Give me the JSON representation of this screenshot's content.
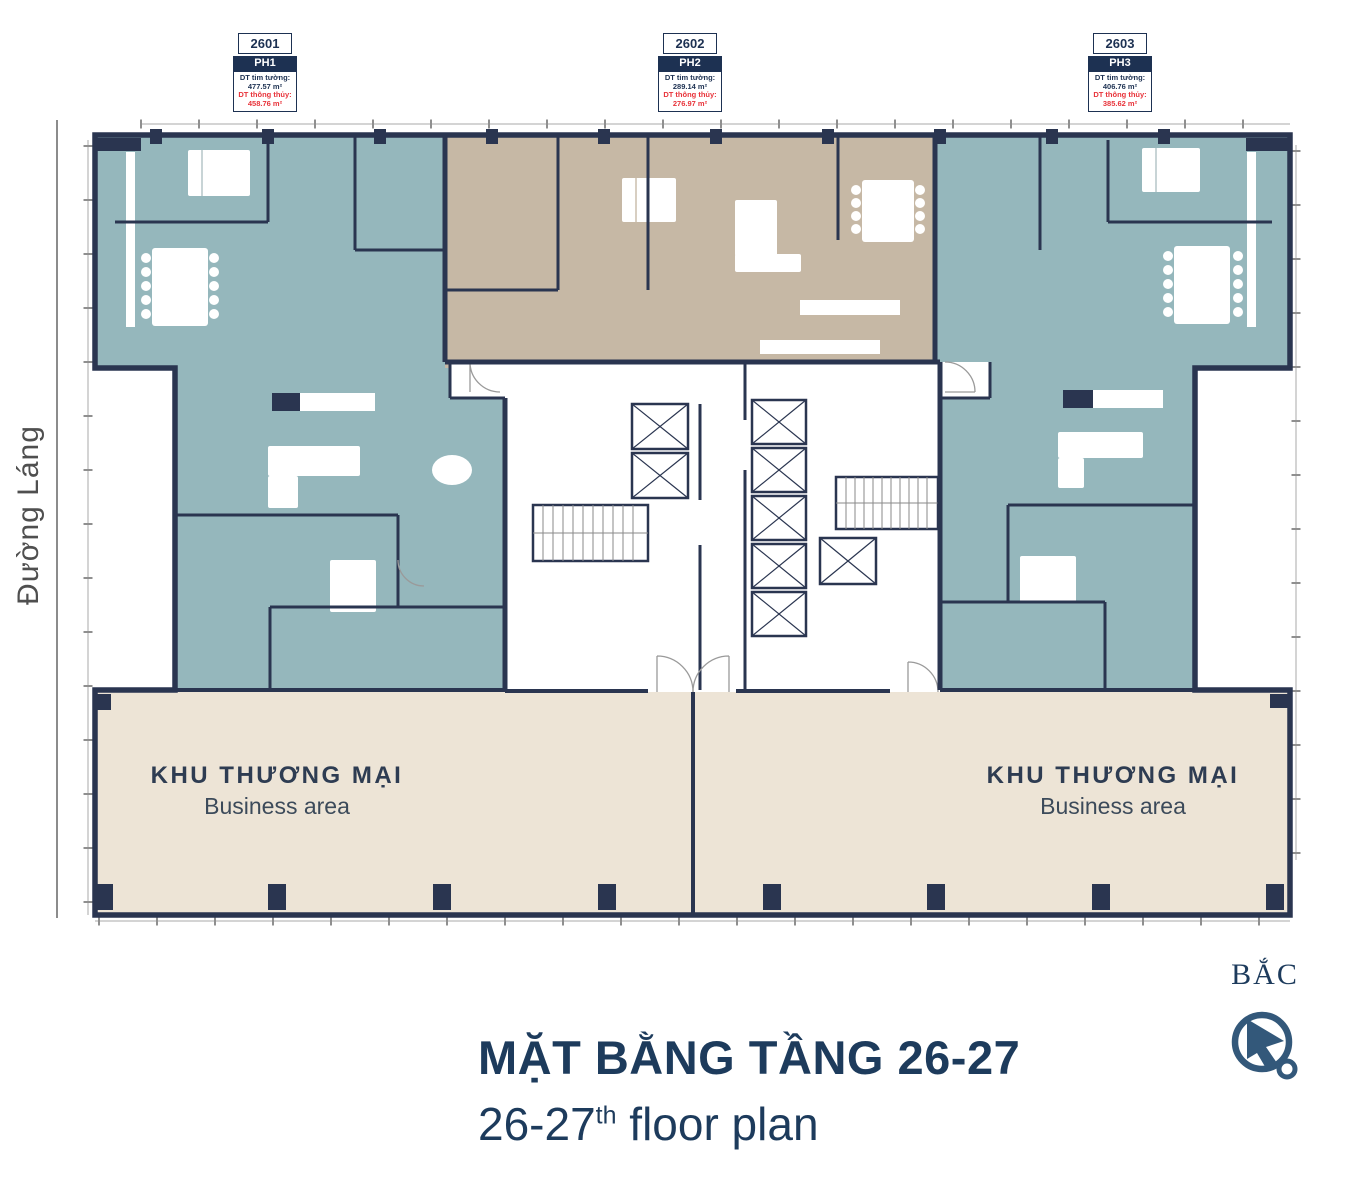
{
  "plan": {
    "units": [
      {
        "number": "2601",
        "name": "PH1",
        "area1_label": "DT tim tường:",
        "area1_value": "477.57 m²",
        "area2_label": "DT thông thủy:",
        "area2_value": "458.76 m²"
      },
      {
        "number": "2602",
        "name": "PH2",
        "area1_label": "DT tim tường:",
        "area1_value": "289.14 m²",
        "area2_label": "DT thông thủy:",
        "area2_value": "276.97 m²"
      },
      {
        "number": "2603",
        "name": "PH3",
        "area1_label": "DT tim tường:",
        "area1_value": "406.76 m²",
        "area2_label": "DT thông thủy:",
        "area2_value": "385.62 m²"
      }
    ],
    "street_label": "Đường Láng",
    "business_left": {
      "vi": "KHU THƯƠNG MẠI",
      "en": "Business area"
    },
    "business_right": {
      "vi": "KHU THƯƠNG MẠI",
      "en": "Business area"
    },
    "compass_label": "BẮC"
  },
  "footer": {
    "title": "MẶT BẰNG TẦNG 26-27",
    "subtitle_floors": "26-27",
    "subtitle_ordinal": "th",
    "subtitle_rest": " floor plan"
  },
  "colors": {
    "apartment_teal": "#95b7bc",
    "penthouse_tan": "#c6b8a5",
    "business_beige": "#ede4d6",
    "wall_navy": "#2a3550",
    "label_navy": "#1d3152",
    "accent_red": "#e8333a",
    "title_navy": "#1d3b5c"
  }
}
